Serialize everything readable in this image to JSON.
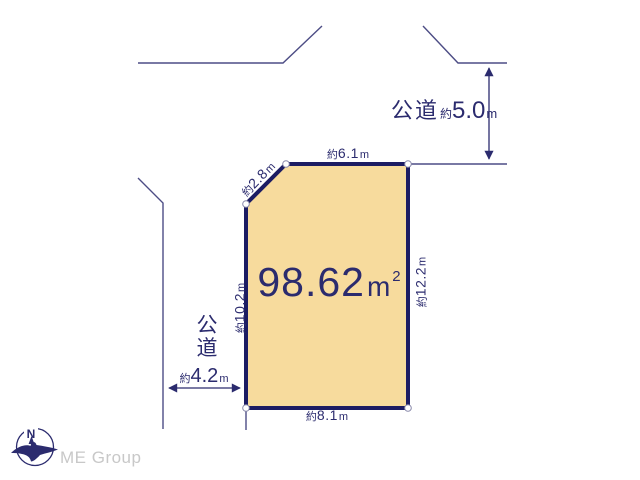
{
  "plot": {
    "area": {
      "value": "98.62",
      "unit_base": "m",
      "unit_sup": "2"
    },
    "dimensions": {
      "top": {
        "approx": "約",
        "value": "6.1",
        "unit": "m"
      },
      "chamfer": {
        "approx": "約",
        "value": "2.8",
        "unit": "m"
      },
      "right": {
        "approx": "約",
        "value": "12.2",
        "unit": "m"
      },
      "left": {
        "approx": "約",
        "value": "10.2",
        "unit": "m"
      },
      "bottom": {
        "approx": "約",
        "value": "8.1",
        "unit": "m"
      }
    }
  },
  "roads": {
    "top": {
      "name": "公道",
      "approx": "約",
      "value": "5.0",
      "unit": "m"
    },
    "left": {
      "name_line1": "公",
      "name_line2": "道",
      "approx": "約",
      "value": "4.2",
      "unit": "m"
    }
  },
  "compass": {
    "north": "N"
  },
  "footer": {
    "brand": "ME Group"
  },
  "colors": {
    "plot_fill": "#f7db9d",
    "plot_border": "#1c1c63",
    "ink_navy": "#2b2b6e",
    "road_line": "#4d4d85",
    "brand_gray": "#c8c8c8"
  }
}
